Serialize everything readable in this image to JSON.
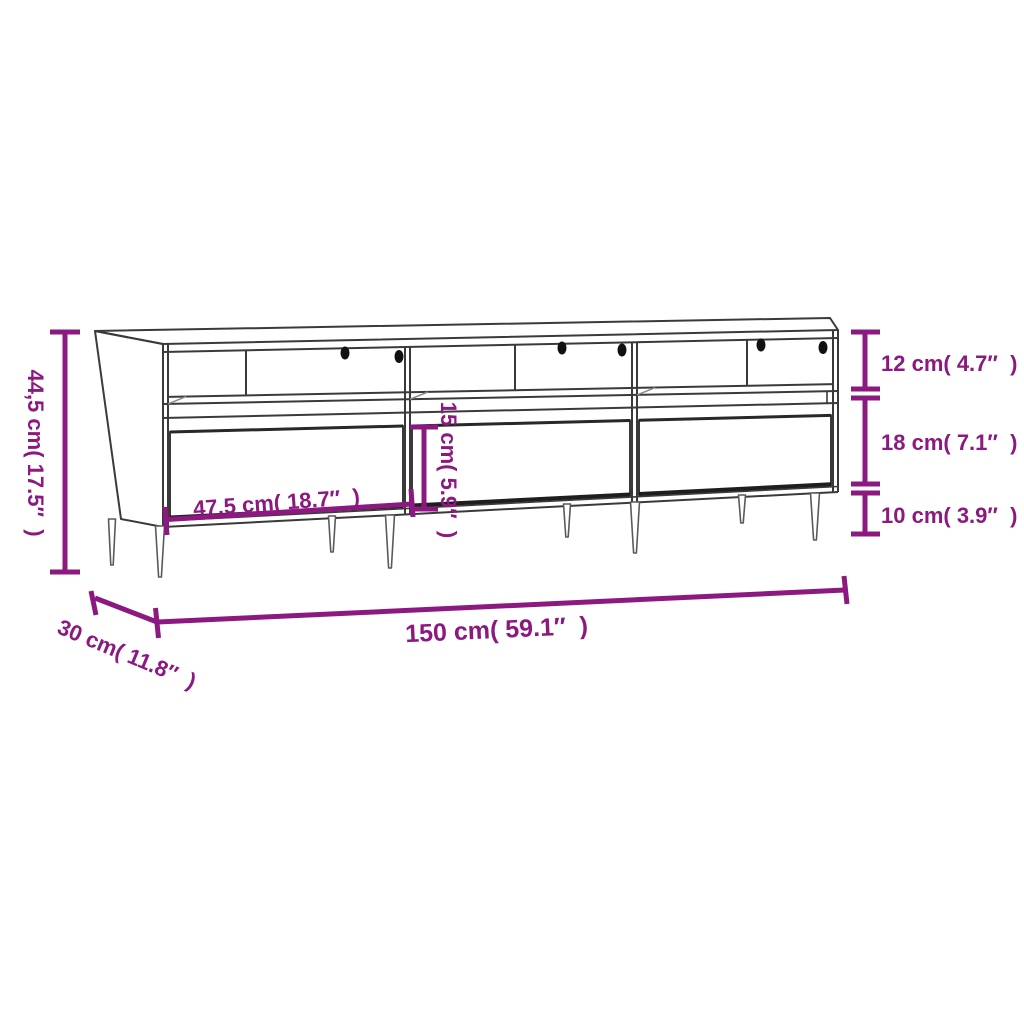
{
  "diagram": {
    "type": "furniture-dimension-diagram",
    "product": "TV cabinet with 3 drawers, open shelf compartments, cable holes and tapered legs",
    "background_color": "#ffffff",
    "accent_color": "#8B1980",
    "line_color": "#3a3a3a",
    "labels": {
      "overall_height": "44,5 cm( 17.5″  )",
      "shelf_section_height": "12 cm( 4.7″  )",
      "drawer_section_height": "18 cm( 7.1″  )",
      "leg_height": "10 cm( 3.9″  )",
      "drawer_width": "47,5 cm( 18.7″  )",
      "drawer_front_height": "15 cm( 5.9″  )",
      "overall_width": "150 cm( 59.1″  )",
      "overall_depth": "30 cm( 11.8″  )"
    }
  }
}
